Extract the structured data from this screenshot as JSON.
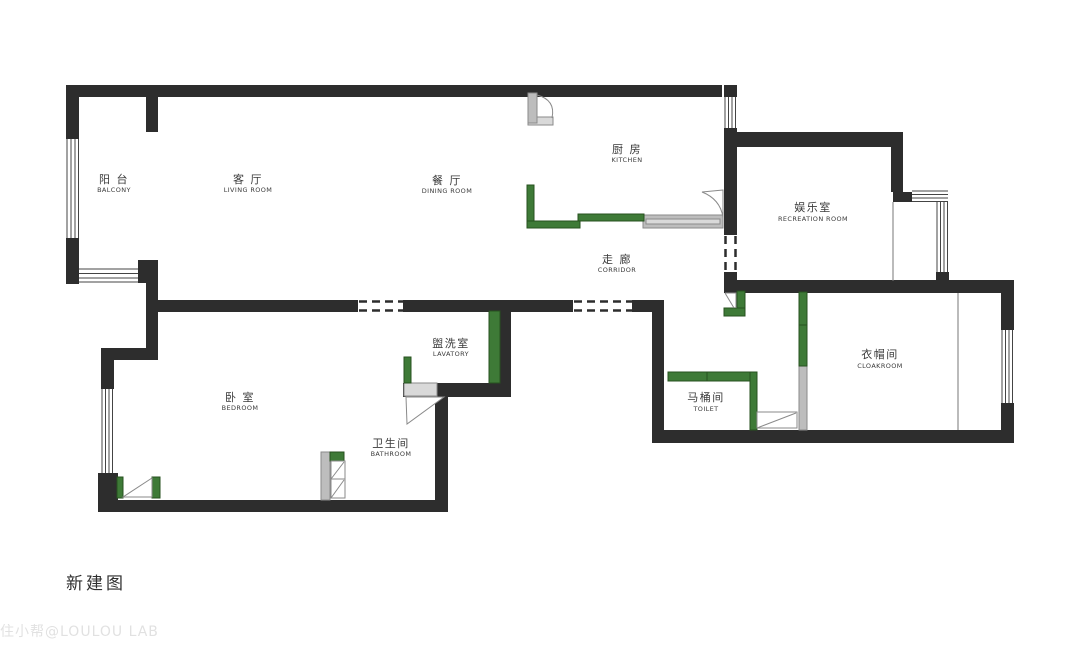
{
  "meta": {
    "drawing_title": "新建图",
    "watermark": "住小帮@LOULOU LAB"
  },
  "colors": {
    "background": "#ffffff",
    "wall": "#2d2d2d",
    "line": "#444444",
    "thin": "#777777",
    "green": "#3e7a37",
    "green_border": "#27511f",
    "gray": "#bdbdbd",
    "gray_border": "#8a8a8a",
    "sill": "#d9d9d9",
    "swing": "#8a8a8a",
    "label": "#3a3a3a",
    "title": "#2f2f2f",
    "watermark": "#c9c9c9"
  },
  "rooms": [
    {
      "id": "balcony",
      "zh": "阳 台",
      "en": "BALCONY"
    },
    {
      "id": "living-room",
      "zh": "客 厅",
      "en": "LIVING ROOM"
    },
    {
      "id": "dining-room",
      "zh": "餐 厅",
      "en": "DINING ROOM"
    },
    {
      "id": "kitchen",
      "zh": "厨 房",
      "en": "KITCHEN"
    },
    {
      "id": "recreation-room",
      "zh": "娱乐室",
      "en": "RECREATION ROOM"
    },
    {
      "id": "corridor",
      "zh": "走 廊",
      "en": "CORRIDOR"
    },
    {
      "id": "lavatory",
      "zh": "盥洗室",
      "en": "LAVATORY"
    },
    {
      "id": "bedroom",
      "zh": "卧 室",
      "en": "BEDROOM"
    },
    {
      "id": "bathroom",
      "zh": "卫生间",
      "en": "BATHROOM"
    },
    {
      "id": "toilet",
      "zh": "马桶间",
      "en": "TOILET"
    },
    {
      "id": "cloakroom",
      "zh": "衣帽间",
      "en": "CLOAKROOM"
    }
  ]
}
